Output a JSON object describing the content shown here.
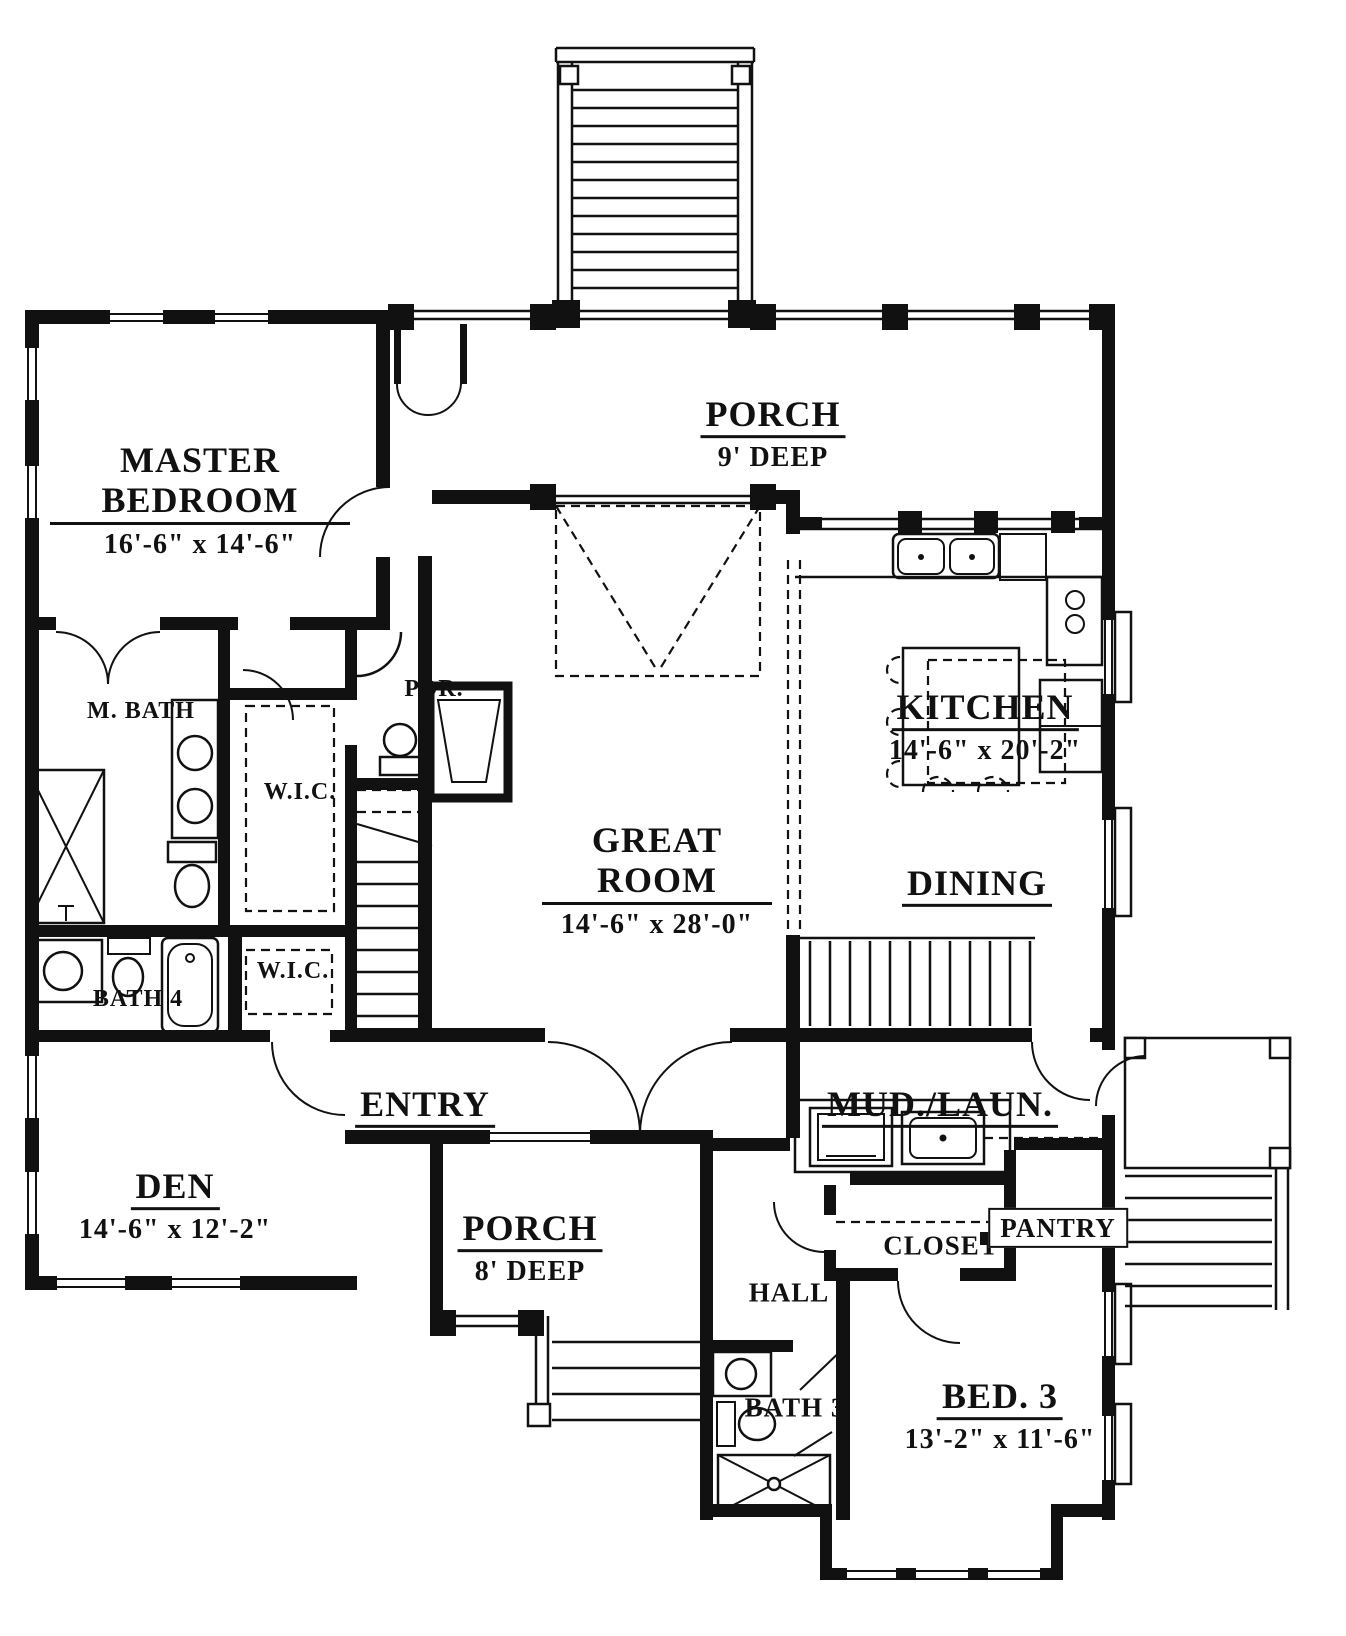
{
  "palette": {
    "ink": "#111111",
    "paper": "#ffffff"
  },
  "rooms": [
    {
      "id": "porch-top",
      "name": "PORCH",
      "dims": "9' DEEP"
    },
    {
      "id": "master-bedroom",
      "name": "MASTER BEDROOM",
      "dims": "16'-6\" x 14'-6\""
    },
    {
      "id": "master-bath",
      "name": "M. BATH",
      "dims": ""
    },
    {
      "id": "wic-master",
      "name": "W.I.C.",
      "dims": ""
    },
    {
      "id": "powder-room",
      "name": "PDR.",
      "dims": ""
    },
    {
      "id": "kitchen",
      "name": "KITCHEN",
      "dims": "14'-6\" x 20'-2\""
    },
    {
      "id": "great-room",
      "name": "GREAT ROOM",
      "dims": "14'-6\" x 28'-0\""
    },
    {
      "id": "dining",
      "name": "DINING",
      "dims": ""
    },
    {
      "id": "bath-4",
      "name": "BATH 4",
      "dims": ""
    },
    {
      "id": "wic-2",
      "name": "W.I.C.",
      "dims": ""
    },
    {
      "id": "entry",
      "name": "ENTRY",
      "dims": ""
    },
    {
      "id": "mud-laundry",
      "name": "MUD./LAUN.",
      "dims": ""
    },
    {
      "id": "den",
      "name": "DEN",
      "dims": "14'-6\" x 12'-2\""
    },
    {
      "id": "porch-front",
      "name": "PORCH",
      "dims": "8' DEEP"
    },
    {
      "id": "hall",
      "name": "HALL",
      "dims": ""
    },
    {
      "id": "closet",
      "name": "CLOSET",
      "dims": ""
    },
    {
      "id": "pantry",
      "name": "PANTRY",
      "dims": ""
    },
    {
      "id": "bath-3",
      "name": "BATH 3",
      "dims": ""
    },
    {
      "id": "bed-3",
      "name": "BED. 3",
      "dims": "13'-2\" x 11'-6\""
    }
  ]
}
